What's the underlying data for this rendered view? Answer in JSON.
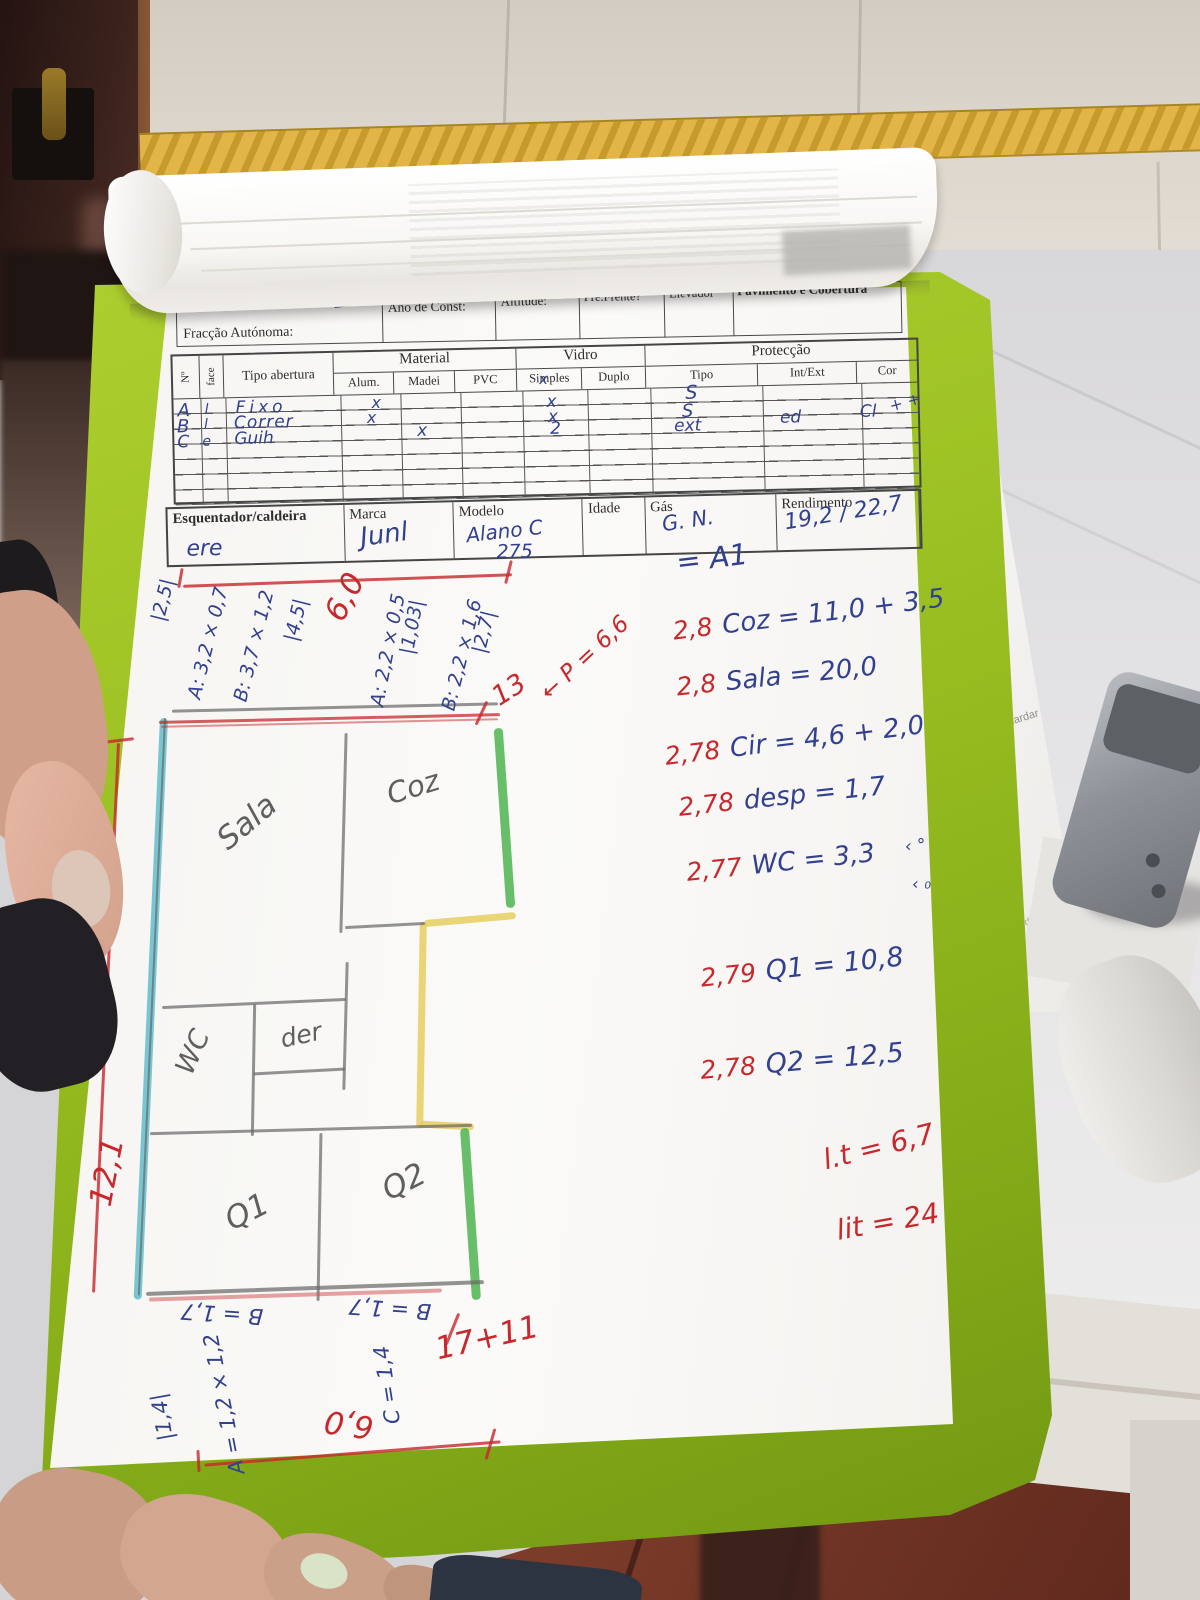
{
  "photo": {
    "colors": {
      "clipboard_green": "#9fc222",
      "pen_blue": "#32418f",
      "pen_red": "#c8272c",
      "highlight_cyan": "#54b8c6",
      "highlight_green": "#3fae41",
      "highlight_yellow": "#e5cb52",
      "tile_border_yellow": "#d9a833"
    }
  },
  "form": {
    "header": {
      "fraccao": "Fracção Autónoma:",
      "ano": "Ano de Const:",
      "altitude": "Altitude:",
      "pre_frente": "Pré.Frente?",
      "elevador": "Elevador",
      "pavimento": "Pavimento e Cobertura"
    },
    "table": {
      "col_n": "Nº",
      "col_face": "face",
      "col_tipo": "Tipo abertura",
      "group_material": "Material",
      "col_alum": "Alum.",
      "col_madei": "Madei",
      "col_pvc": "PVC",
      "group_vidro": "Vidro",
      "col_simples": "Simples",
      "col_duplo": "Duplo",
      "group_proteccao": "Protecção",
      "col_prot_tipo": "Tipo",
      "col_int_ext": "Int/Ext",
      "col_cor": "Cor",
      "rows": [
        {
          "n": "A",
          "face": "l",
          "tipo": "Fixo",
          "alum": "x",
          "madei": "",
          "pvc": "",
          "simples": "x",
          "duplo": "",
          "prot_tipo": "S",
          "int_ext": "",
          "cor": ""
        },
        {
          "n": "B",
          "face": "l",
          "tipo": "Correr",
          "alum": "x",
          "madei": "",
          "pvc": "",
          "simples": "x",
          "duplo": "",
          "prot_tipo": "S",
          "int_ext": "",
          "cor": ""
        },
        {
          "n": "C",
          "face": "e",
          "tipo": "Guih",
          "alum": "",
          "madei": "x",
          "pvc": "",
          "simples": "2",
          "duplo": "",
          "prot_tipo": "ext",
          "int_ext": "ed",
          "cor": "Cl"
        }
      ],
      "margin_marks": "+ +"
    },
    "heater": {
      "label": "Esquentador/caldeira",
      "marca_label": "Marca",
      "modelo_label": "Modelo",
      "idade_label": "Idade",
      "gas_label": "Gás",
      "rendimento_label": "Rendimento",
      "value": "ere",
      "marca": "Junl",
      "modelo": "Alano C",
      "modelo_line2": "275",
      "idade": "",
      "gas": "G. N.",
      "rendimento": "19,2 / 22,7"
    }
  },
  "plan": {
    "rooms": {
      "sala": "Sala",
      "coz": "Coz",
      "wc": "WC",
      "desp": "der",
      "q1": "Q1",
      "q2": "Q2"
    }
  },
  "notes": {
    "a1": "= A1",
    "eq": [
      {
        "coef": "2,8",
        "body": "Coz = 11,0 + 3,5"
      },
      {
        "coef": "2,8",
        "body": "Sala = 20,0"
      },
      {
        "coef": "2,78",
        "body": "Cir = 4,6 + 2,0"
      },
      {
        "coef": "2,78",
        "body": "desp = 1,7"
      },
      {
        "coef": "2,77",
        "body": "WC = 3,3"
      },
      {
        "coef": "2,79",
        "body": "Q1 = 10,8"
      },
      {
        "coef": "2,78",
        "body": "Q2 = 12,5"
      }
    ],
    "wc_mark_1": "‹ °",
    "wc_mark_2": "‹ ₀",
    "lit_1": "l.t = 6,7",
    "lit_2": "lit = 24",
    "dim_top": "6,0",
    "dim_13": "13",
    "arrow": "←",
    "dim_p": "P = 6,6",
    "dim_left_total": "12,1",
    "dim_bottom_total": "17+11",
    "dim_bottom_six": "6,0",
    "left_dims": [
      "|2,5|",
      "A: 3,2 × 0,7",
      "B: 3,7 × 1,2",
      "|4,5|",
      "A: 2,2 × 0,5",
      "|1,03|",
      "B: 2,2 × 1,6",
      "|2,7|"
    ],
    "bottom_dims": [
      "B = 1,7",
      "B = 1,7",
      "C = 1,4",
      "A = 1,2 × 1,2",
      "|1,4|"
    ]
  },
  "background": {
    "doc_text_1": "ambos guardar",
    "doc_text_2": "MobiDedPrazCert"
  }
}
